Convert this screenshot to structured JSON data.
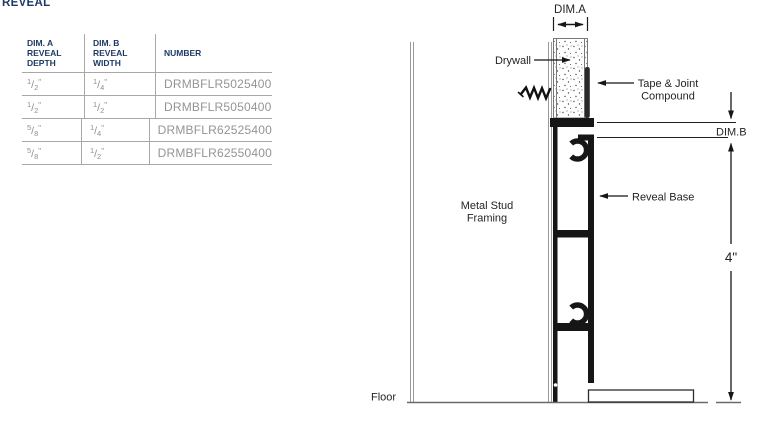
{
  "page": {
    "title": "REVEAL"
  },
  "table": {
    "headers": {
      "col1_line1": "DIM. A",
      "col1_line2": "REVEAL",
      "col1_line3": "DEPTH",
      "col2_line1": "DIM. B",
      "col2_line2": "REVEAL",
      "col2_line3": "WIDTH",
      "col3": "NUMBER"
    },
    "frac_slash": "/",
    "unit_mark": "\"",
    "rows": [
      {
        "a_num": "1",
        "a_den": "2",
        "b_num": "1",
        "b_den": "4",
        "number": "DRMBFLR5025400"
      },
      {
        "a_num": "1",
        "a_den": "2",
        "b_num": "1",
        "b_den": "2",
        "number": "DRMBFLR5050400"
      },
      {
        "a_num": "5",
        "a_den": "8",
        "b_num": "1",
        "b_den": "4",
        "number": "DRMBFLR62525400"
      },
      {
        "a_num": "5",
        "a_den": "8",
        "b_num": "1",
        "b_den": "2",
        "number": "DRMBFLR62550400"
      }
    ]
  },
  "diagram": {
    "labels": {
      "dim_a": "DIM.A",
      "dim_b": "DIM.B",
      "drywall": "Drywall",
      "tape_joint_line1": "Tape & Joint",
      "tape_joint_line2": "Compound",
      "reveal_base": "Reveal Base",
      "metal_stud_line1": "Metal Stud",
      "metal_stud_line2": "Framing",
      "floor": "Floor",
      "height": "4\""
    },
    "colors": {
      "profile_black": "#161616",
      "stud_line_gray": "#989898",
      "label_text": "#242424",
      "heading_navy": "#1d3a66",
      "table_text_gray": "#8f8f8f",
      "table_line_gray": "#a8a8a8"
    }
  }
}
